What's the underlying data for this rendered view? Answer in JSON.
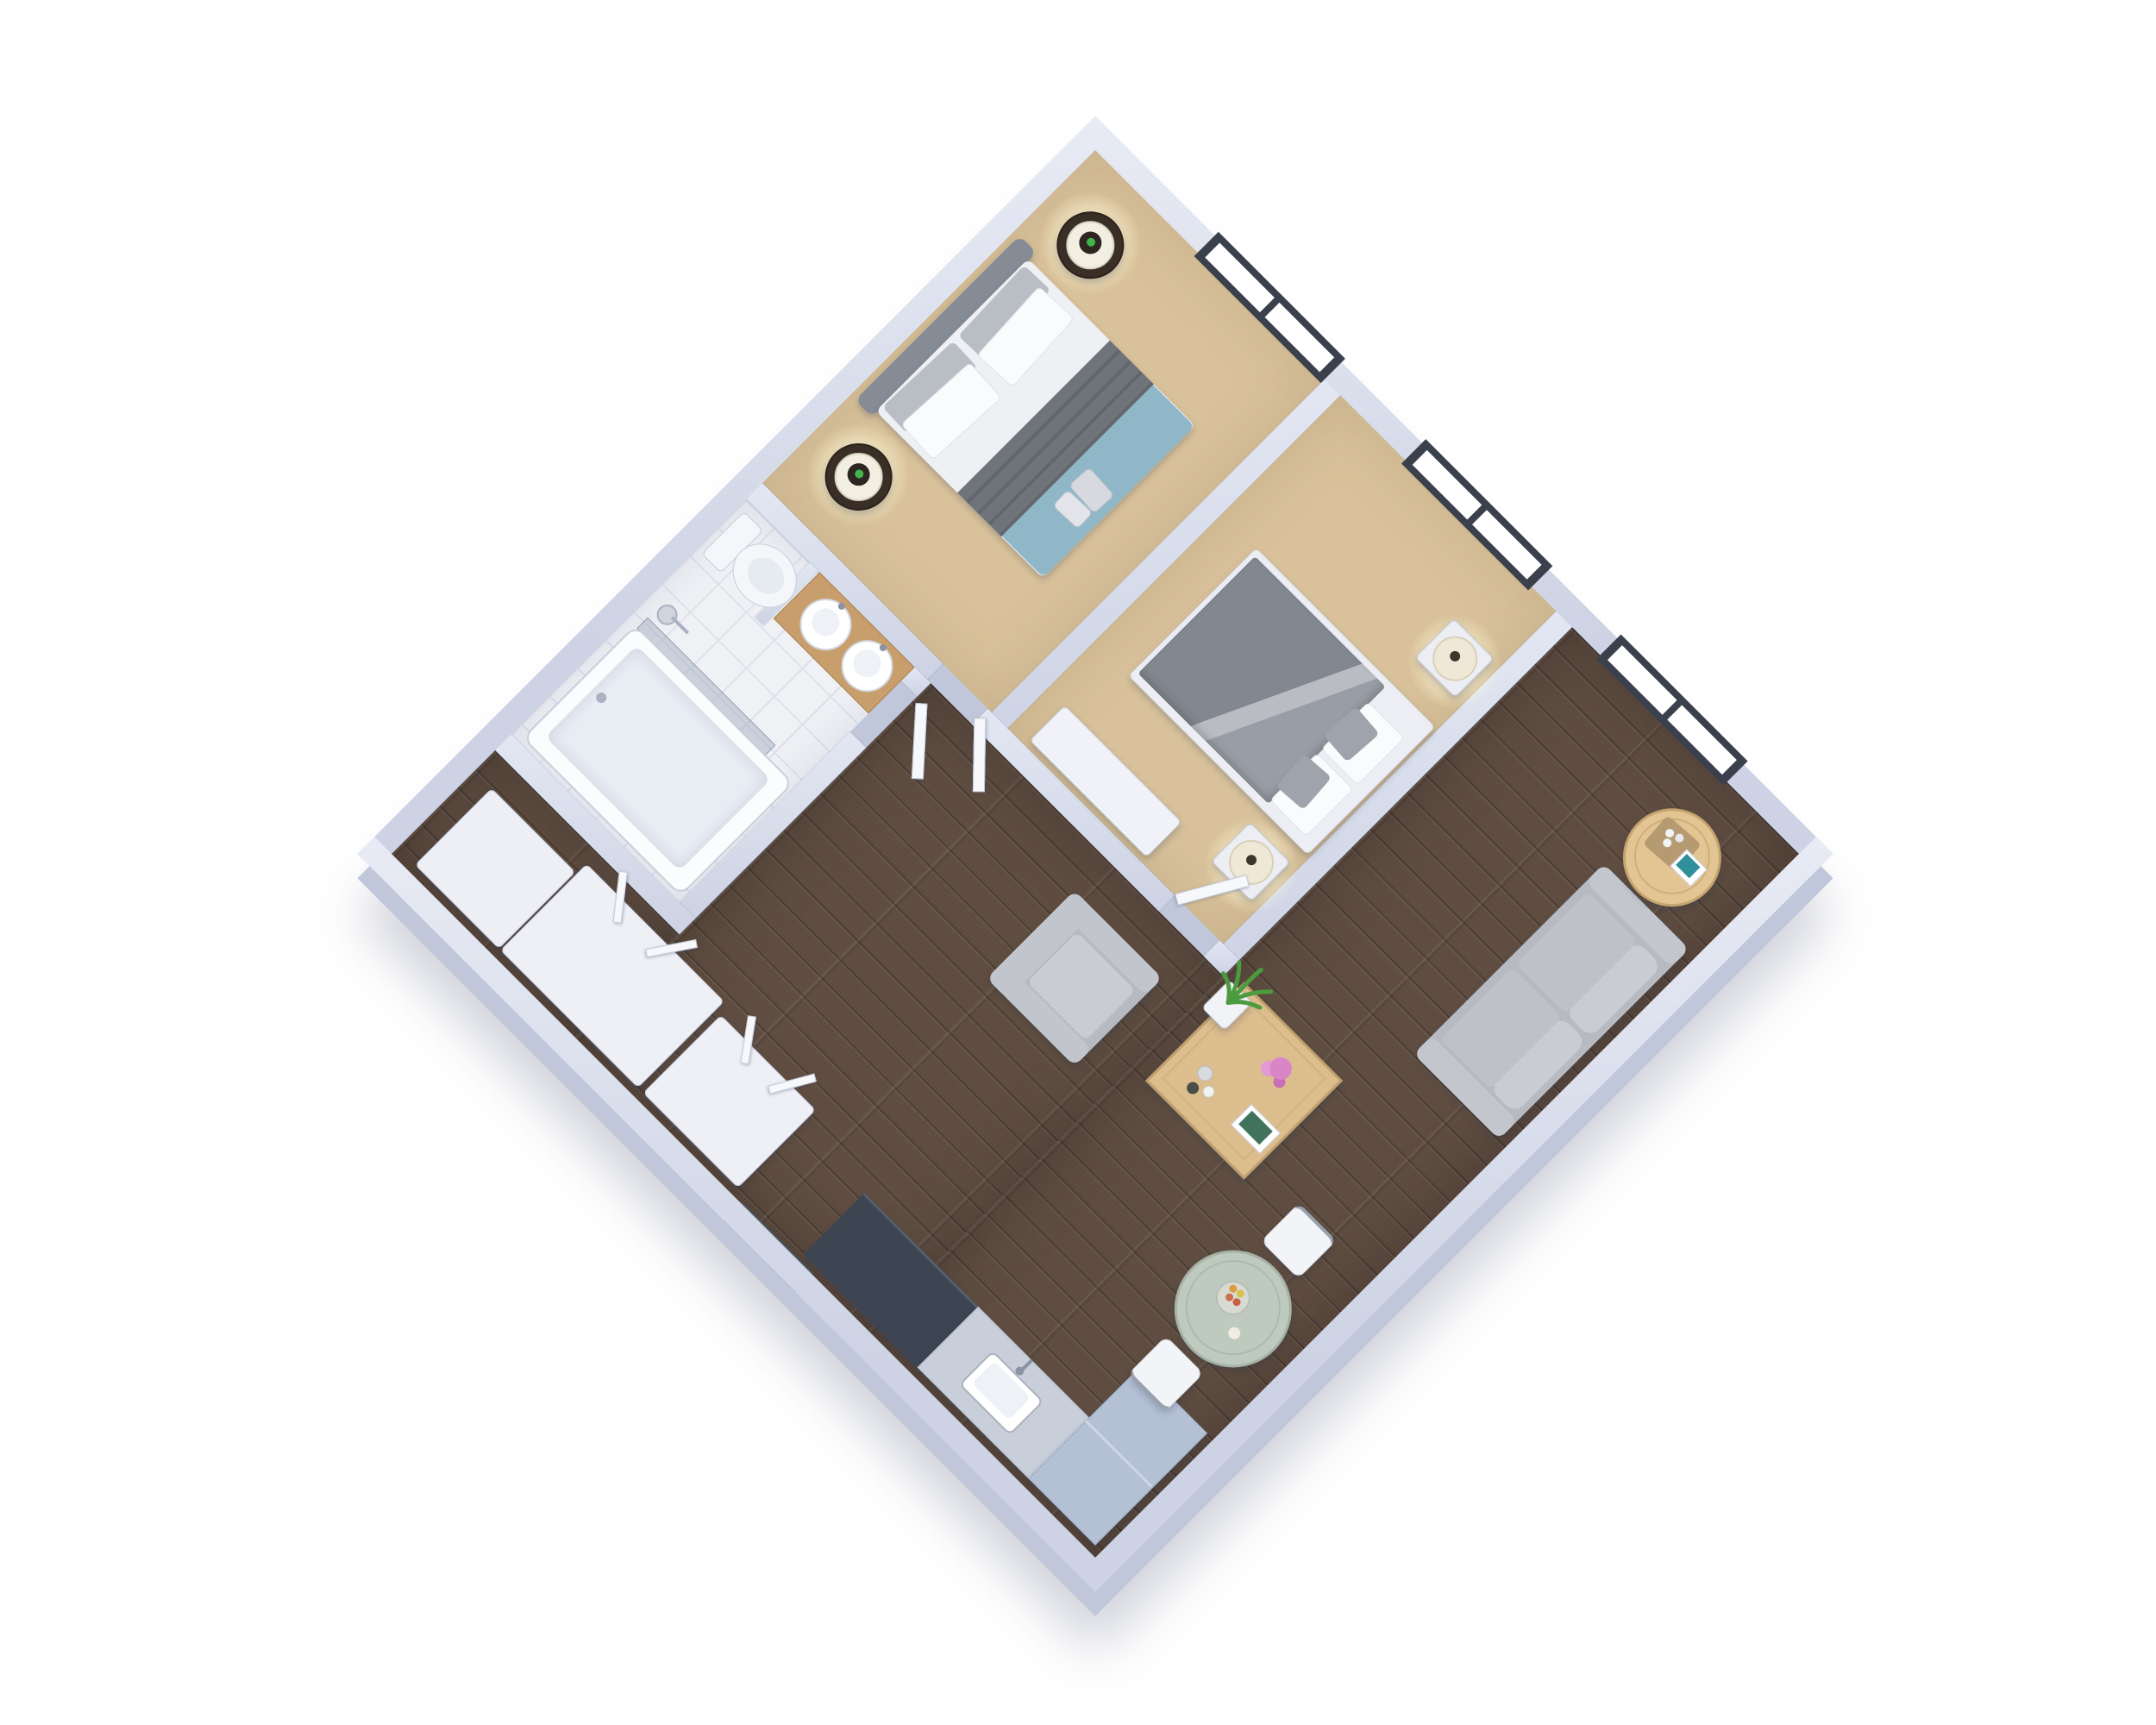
{
  "scene": {
    "title": "3D floor plan render of a one-bedroom-plus-den apartment, top-down rotated 45 degrees",
    "type": "3d-floor-plan",
    "background": "#ffffff",
    "orientation": "diamond (square rotated 45 deg), windows along upper-right exterior wall, entry on lower-left wall"
  },
  "palette": {
    "background": "#ffffff",
    "wall": "#cdd3e4",
    "wall-dark": "#c0c7da",
    "carpet": "#d9c29b",
    "wood": "#5f4d41",
    "tile": "#eff1f5",
    "tile-line": "#dde1e9",
    "window-frame": "#3a414d",
    "glass": "#ffffff",
    "door-white": "#f7f8fb",
    "entry-door": "#5a6272",
    "sofa": "#b7bac1",
    "cushion": "#c9ccd3",
    "table-wood": "#dcbd8e",
    "side-table-wood": "#e3c493",
    "dining-top": "#bfcabf",
    "chair-white": "#f3f4f7",
    "duvet-gray": "#83878f",
    "throw-gray": "#6f737a",
    "blanket-blue": "#8fb7c7",
    "pillow-white": "#fafbfd",
    "pillow-gray": "#b9bdc4",
    "nightstand-dark": "#3a2f26",
    "nightstand-white": "#eceef4",
    "lamp-shade": "#f2efe2",
    "lamp-cream": "#efe8d6",
    "lamp-green": "#43b54d",
    "counter-dark": "#3e4552",
    "counter-steel": "#c8cfdb",
    "fridge-blue": "#b4c0d5",
    "fixture-white": "#f4f6fa",
    "vanity-wood": "#c79e6c",
    "plant-green": "#4c9b3e",
    "flower-pink": "#d985c8",
    "book-teal": "#41735c"
  },
  "rooms": [
    {
      "id": "bedroom-1",
      "name": "Bedroom 1 (beige carpet, bed with blue throw)",
      "floor": "carpet"
    },
    {
      "id": "bedroom-2",
      "name": "Bedroom 2 (beige carpet, gray duvet bed)",
      "floor": "carpet"
    },
    {
      "id": "bathroom",
      "name": "Bathroom (white tile, tub, toilet, double vanity)",
      "floor": "tile"
    },
    {
      "id": "hallway",
      "name": "Hallway with wardrobe closets and entry",
      "floor": "wood"
    },
    {
      "id": "living-room",
      "name": "Living room (dark hardwood)",
      "floor": "wood"
    },
    {
      "id": "dining-area",
      "name": "Dining area (round table for two)",
      "floor": "wood"
    },
    {
      "id": "kitchen",
      "name": "Kitchen corner (cooktop counter, sink, fridge)",
      "floor": "wood"
    }
  ],
  "windows": {
    "count": 3,
    "location": "upper-right exterior wall",
    "style": "dark charcoal frame, two white glass panes each"
  },
  "furniture": {
    "bedroom1": [
      {
        "label": "Double bed: gray headboard, white duvet, gray throw, blue blanket with folded towels"
      },
      {
        "label": "Round dark-brown nightstand with white-shade lamp (x2)"
      }
    ],
    "bedroom2": [
      {
        "label": "Platform bed: white base, folded dark-gray duvet, white and gray pillows"
      },
      {
        "label": "White cube nightstand with cream drum lamp (x2)"
      },
      {
        "label": "Low white dresser"
      }
    ],
    "bathroom": [
      {
        "label": "Bathtub with glass shower screen and shower head"
      },
      {
        "label": "Toilet"
      },
      {
        "label": "Wood vanity with two round basins"
      }
    ],
    "hallway": [
      {
        "label": "White wardrobe closets with open doors (x2)"
      },
      {
        "label": "Dark entry door on lower-left wall"
      }
    ],
    "living": [
      {
        "label": "Gray two-seat sofa against lower-right wall"
      },
      {
        "label": "Gray armchair"
      },
      {
        "label": "Square wood coffee table with pink flowers, book and candles"
      },
      {
        "label": "Round wood side table with serving board and teal book"
      },
      {
        "label": "Potted green plant by bedroom wall"
      }
    ],
    "dining": [
      {
        "label": "Round pale-sage dining table with fruit bowl and candle"
      },
      {
        "label": "White cantilever chair (x2)"
      }
    ],
    "kitchen": [
      {
        "label": "Dark charcoal cooktop counter"
      },
      {
        "label": "Steel-gray sink counter with faucet"
      },
      {
        "label": "Light-blue refrigerator cabinet in bottom corner"
      }
    ]
  }
}
